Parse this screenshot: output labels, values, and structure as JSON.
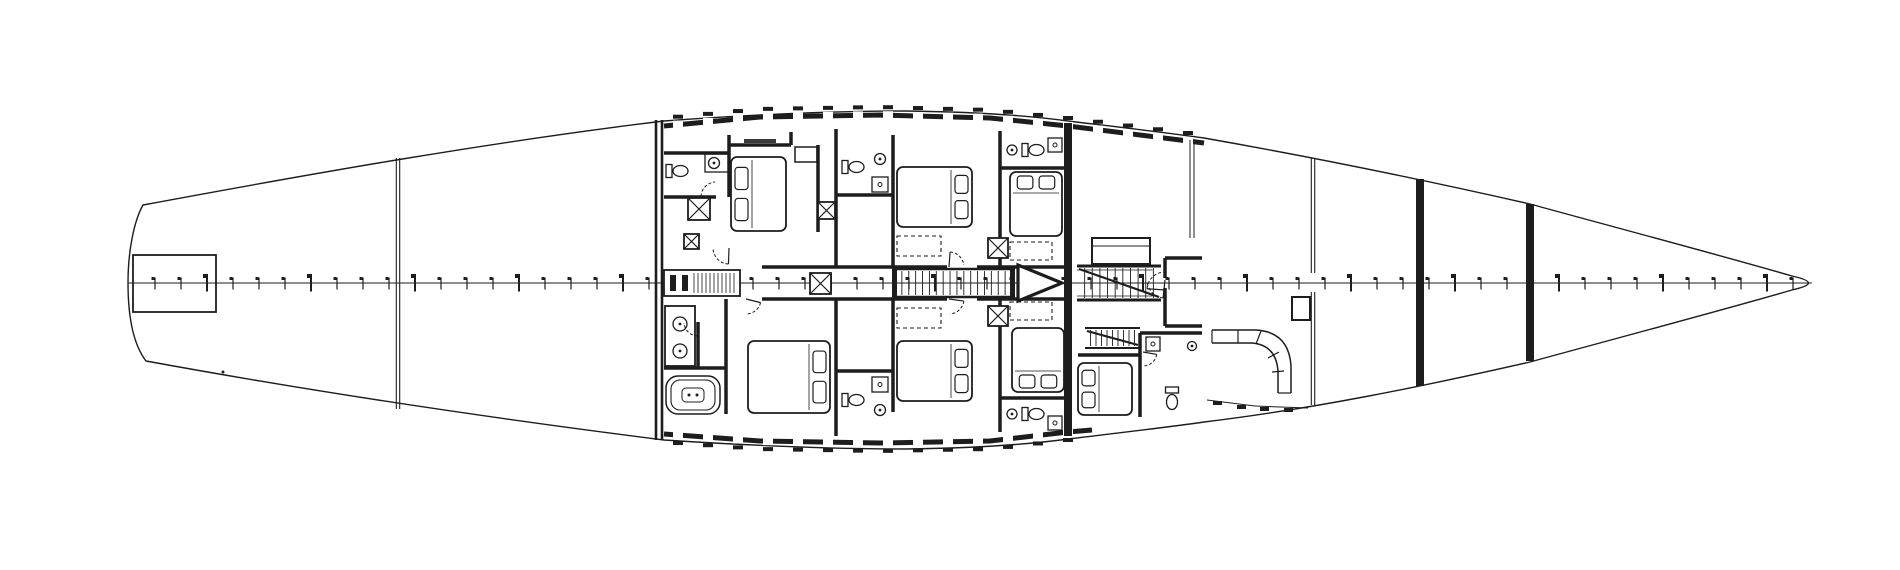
{
  "meta": {
    "type": "Sailing yacht general arrangement drawing - lower deck accommodation plan",
    "ink": "#1d1d1d",
    "bg": "#ffffff",
    "canvas_w": 1900,
    "canvas_h": 570
  },
  "plan": {
    "hull": {
      "outline_d": "M 143 205 C 310 174 490 142 664 121 C 780 112.5 850 111 905 111 C 990 112 1040 117 1072 121.5 C 1118 127 1162 132 1204 138 C 1312 157 1420 179 1530 204 C 1612 226.5 1725 256.5 1792 276 C 1814 281 1814 285 1792 290 C 1725 309.5 1612 339.5 1530 362 C 1420 387 1312 409 1204 422 C 1162 428 1118 433 1072 438.5 C 1040 443 990 448 905 449 C 850 449 780 447.5 664 440 C 490 418 310 391 146 361 C 133 344 128 315 128 283 C 128 251 134 221 143 205 Z",
      "centerline": {
        "x1": 128,
        "y": 283,
        "x2": 1812
      },
      "ticks": {
        "x_start": 155,
        "spacing": 26,
        "count": 64,
        "major_every": 4
      },
      "stern_box": {
        "x": 133,
        "y": 255,
        "w": 83,
        "h": 57
      }
    },
    "bulkheads": [
      {
        "type": "double-thin",
        "x": 398,
        "gap": 3.4,
        "y1": 158,
        "y2": 409,
        "w": 1.1
      },
      {
        "type": "double-thick",
        "x": 659,
        "gap": 6,
        "y1": 120,
        "y2": 440,
        "w": 2.6
      },
      {
        "type": "solid",
        "x": 1068,
        "w": 8,
        "y1": 123,
        "y2": 436
      },
      {
        "type": "double-thin",
        "x": 1313,
        "gap": 3.4,
        "y1": 158,
        "y2": 273,
        "w": 1.1
      },
      {
        "type": "double-thin",
        "x": 1313,
        "gap": 3.4,
        "y1": 292,
        "y2": 405,
        "w": 1.1
      },
      {
        "type": "solid",
        "x": 1420,
        "w": 8,
        "y1": 179,
        "y2": 386
      },
      {
        "type": "solid",
        "x": 1530,
        "w": 8,
        "y1": 204,
        "y2": 361
      }
    ],
    "deck_walls": [
      {
        "side": "top",
        "pts": [
          [
            664,
            126
          ],
          [
            760,
            117
          ],
          [
            880,
            115
          ],
          [
            990,
            118
          ],
          [
            1068,
            126
          ],
          [
            1204,
            143
          ]
        ],
        "notch_from": 678,
        "notch_to": 1192,
        "step": 30
      },
      {
        "side": "bottom",
        "pts": [
          [
            664,
            434
          ],
          [
            760,
            441
          ],
          [
            880,
            443
          ],
          [
            990,
            441
          ],
          [
            1068,
            432
          ],
          [
            1092,
            430
          ]
        ],
        "notch_from": 678,
        "notch_to": 1078,
        "step": 30
      }
    ],
    "walls": [
      [
        664,
        153,
        729,
        153
      ],
      [
        729,
        135,
        729,
        197
      ],
      [
        664,
        197,
        716,
        197
      ],
      [
        729,
        145,
        791,
        145
      ],
      [
        791,
        132,
        791,
        145
      ],
      [
        818,
        145,
        818,
        232
      ],
      [
        762,
        267,
        947,
        267
      ],
      [
        977,
        267,
        1066,
        267
      ],
      [
        762,
        299,
        947,
        299
      ],
      [
        977,
        299,
        1066,
        299
      ],
      [
        836,
        129,
        836,
        267
      ],
      [
        893,
        135,
        893,
        267
      ],
      [
        1000,
        131,
        1000,
        267
      ],
      [
        836,
        195,
        893,
        195
      ],
      [
        1000,
        168,
        1066,
        168
      ],
      [
        836,
        299,
        836,
        436
      ],
      [
        893,
        299,
        893,
        412
      ],
      [
        1000,
        299,
        1000,
        432
      ],
      [
        836,
        371,
        893,
        371
      ],
      [
        1000,
        398,
        1066,
        398
      ],
      [
        664,
        368,
        726,
        368
      ],
      [
        698,
        322,
        698,
        368
      ],
      [
        726,
        299,
        726,
        414
      ],
      [
        1165,
        258,
        1165,
        278
      ],
      [
        1165,
        288,
        1165,
        326
      ],
      [
        1165,
        258,
        1202,
        258
      ],
      [
        1165,
        326,
        1202,
        326
      ],
      [
        1140,
        333,
        1140,
        417
      ],
      [
        1140,
        333,
        1202,
        333
      ],
      [
        1078,
        355,
        1140,
        355
      ]
    ],
    "thin_lines": [
      [
        1190,
        140,
        1190,
        238
      ],
      [
        1194,
        140,
        1194,
        238
      ],
      [
        1092,
        246,
        1150,
        246
      ],
      [
        1207,
        400,
        1255,
        406
      ],
      [
        1255,
        406,
        1308,
        408
      ]
    ],
    "rects": [
      [
        795,
        147,
        22,
        15,
        1.5
      ],
      [
        1092,
        238,
        58,
        26,
        2
      ],
      [
        1292,
        297,
        18,
        23,
        2
      ],
      [
        705,
        154,
        24,
        18,
        1.3
      ],
      [
        665,
        306,
        30,
        60,
        1.8
      ]
    ],
    "dashed_rects": [
      [
        897,
        236,
        44,
        20
      ],
      [
        1010,
        242,
        42,
        18
      ],
      [
        897,
        308,
        44,
        20
      ],
      [
        1010,
        302,
        42,
        18
      ]
    ],
    "beds": [
      {
        "x": 731,
        "y": 157,
        "w": 55,
        "h": 74,
        "pillows": "left"
      },
      {
        "x": 748,
        "y": 341,
        "w": 82,
        "h": 72,
        "pillows": "right"
      },
      {
        "x": 897,
        "y": 167,
        "w": 75,
        "h": 60,
        "pillows": "right"
      },
      {
        "x": 1010,
        "y": 172,
        "w": 52,
        "h": 64,
        "pillows": "top"
      },
      {
        "x": 897,
        "y": 341,
        "w": 75,
        "h": 60,
        "pillows": "right"
      },
      {
        "x": 1012,
        "y": 328,
        "w": 52,
        "h": 64,
        "pillows": "bottom"
      },
      {
        "x": 1078,
        "y": 363,
        "w": 54,
        "h": 52,
        "pillows": "left"
      }
    ],
    "toilets": [
      {
        "cx": 679,
        "cy": 171,
        "dir": "e"
      },
      {
        "cx": 855,
        "cy": 167,
        "dir": "e"
      },
      {
        "cx": 855,
        "cy": 400,
        "dir": "e"
      },
      {
        "cx": 1035,
        "cy": 150,
        "dir": "e"
      },
      {
        "cx": 1035,
        "cy": 414,
        "dir": "e"
      },
      {
        "cx": 1172,
        "cy": 402,
        "dir": "n"
      }
    ],
    "sinks": [
      {
        "cx": 714,
        "cy": 163,
        "r": 5.5
      },
      {
        "cx": 880,
        "cy": 159,
        "r": 5.5
      },
      {
        "cx": 880,
        "cy": 410,
        "r": 5.5
      },
      {
        "cx": 1012,
        "cy": 150,
        "r": 5
      },
      {
        "cx": 1012,
        "cy": 414,
        "r": 5
      },
      {
        "cx": 1192,
        "cy": 346,
        "r": 4.5
      },
      {
        "cx": 680,
        "cy": 324,
        "r": 7
      },
      {
        "cx": 680,
        "cy": 351,
        "r": 7
      }
    ],
    "showers": [
      [
        872,
        177,
        16,
        15
      ],
      [
        872,
        377,
        16,
        15
      ],
      [
        1146,
        337,
        14,
        14
      ],
      [
        1048,
        138,
        14,
        14
      ],
      [
        1048,
        416,
        14,
        14
      ]
    ],
    "tub": {
      "x": 666,
      "y": 376,
      "w": 54,
      "h": 38
    },
    "xboxes": [
      [
        688,
        198,
        22
      ],
      [
        684,
        234,
        15
      ],
      [
        818,
        202,
        17
      ],
      [
        810,
        273,
        21
      ],
      [
        988,
        238,
        20
      ],
      [
        988,
        306,
        20
      ]
    ],
    "door_arcs": [
      {
        "cx": 716,
        "cy": 197,
        "r": 15,
        "a1": 182,
        "a2": 266
      },
      {
        "cx": 729,
        "cy": 248,
        "r": 16,
        "a1": 92,
        "a2": 176
      },
      {
        "cx": 698,
        "cy": 322,
        "r": 14,
        "a1": 92,
        "a2": 176
      },
      {
        "cx": 746,
        "cy": 299,
        "r": 15,
        "a1": 14,
        "a2": 88
      },
      {
        "cx": 949,
        "cy": 267,
        "r": 15,
        "a1": 274,
        "a2": 352
      },
      {
        "cx": 949,
        "cy": 299,
        "r": 15,
        "a1": 8,
        "a2": 86
      },
      {
        "cx": 1165,
        "cy": 280,
        "r": 18,
        "a1": 96,
        "a2": 176
      },
      {
        "cx": 1165,
        "cy": 290,
        "r": 18,
        "a1": 184,
        "a2": 264
      },
      {
        "cx": 1143,
        "cy": 352,
        "r": 14,
        "a1": 10,
        "a2": 84
      }
    ],
    "stairs": [
      {
        "x": 895,
        "y": 269,
        "w": 117,
        "h": 28,
        "treads": 16,
        "rail_w": 2.5,
        "mid": true,
        "posts": true
      },
      {
        "x": 1077,
        "y": 266,
        "w": 84,
        "h": 34,
        "treads": 10,
        "rail_w": 3,
        "diag": true,
        "inner": true
      },
      {
        "x": 1085,
        "y": 328,
        "w": 55,
        "h": 20,
        "treads": 9,
        "rail_w": 2,
        "diag": true
      }
    ],
    "arrow": {
      "pts": "1018,265 1018,301 1062,283",
      "w": 3.2
    },
    "settee": {
      "outer": "M 1212 330 L 1256 330 Q 1289 332 1291 366 L 1291 393",
      "inner": "M 1212 343 L 1252 343 Q 1276 345 1278 371 L 1278 393",
      "ends": [
        [
          1212,
          330,
          1212,
          343
        ],
        [
          1278,
          393,
          1291,
          393
        ]
      ],
      "ties": [
        [
          1238,
          330,
          1238,
          343
        ],
        [
          1261,
          331,
          1256,
          344
        ],
        [
          1279,
          352,
          1268,
          358
        ],
        [
          1284,
          371,
          1272,
          372
        ]
      ]
    },
    "equipment": {
      "box": [
        664,
        270,
        76,
        26
      ],
      "bars": [
        [
          670,
          275,
          6,
          16
        ],
        [
          682,
          275,
          6,
          16
        ]
      ],
      "hatch": {
        "x1": 694,
        "x2": 736,
        "y1": 273,
        "y2": 293,
        "step": 4
      }
    },
    "cleats": [
      [
        1213,
        401
      ],
      [
        1237,
        405
      ],
      [
        1260,
        407
      ],
      [
        1284,
        408
      ]
    ],
    "dots": [
      [
        223,
        372
      ]
    ],
    "microtext": [
      [
        744,
        139,
        32,
        4
      ]
    ]
  }
}
